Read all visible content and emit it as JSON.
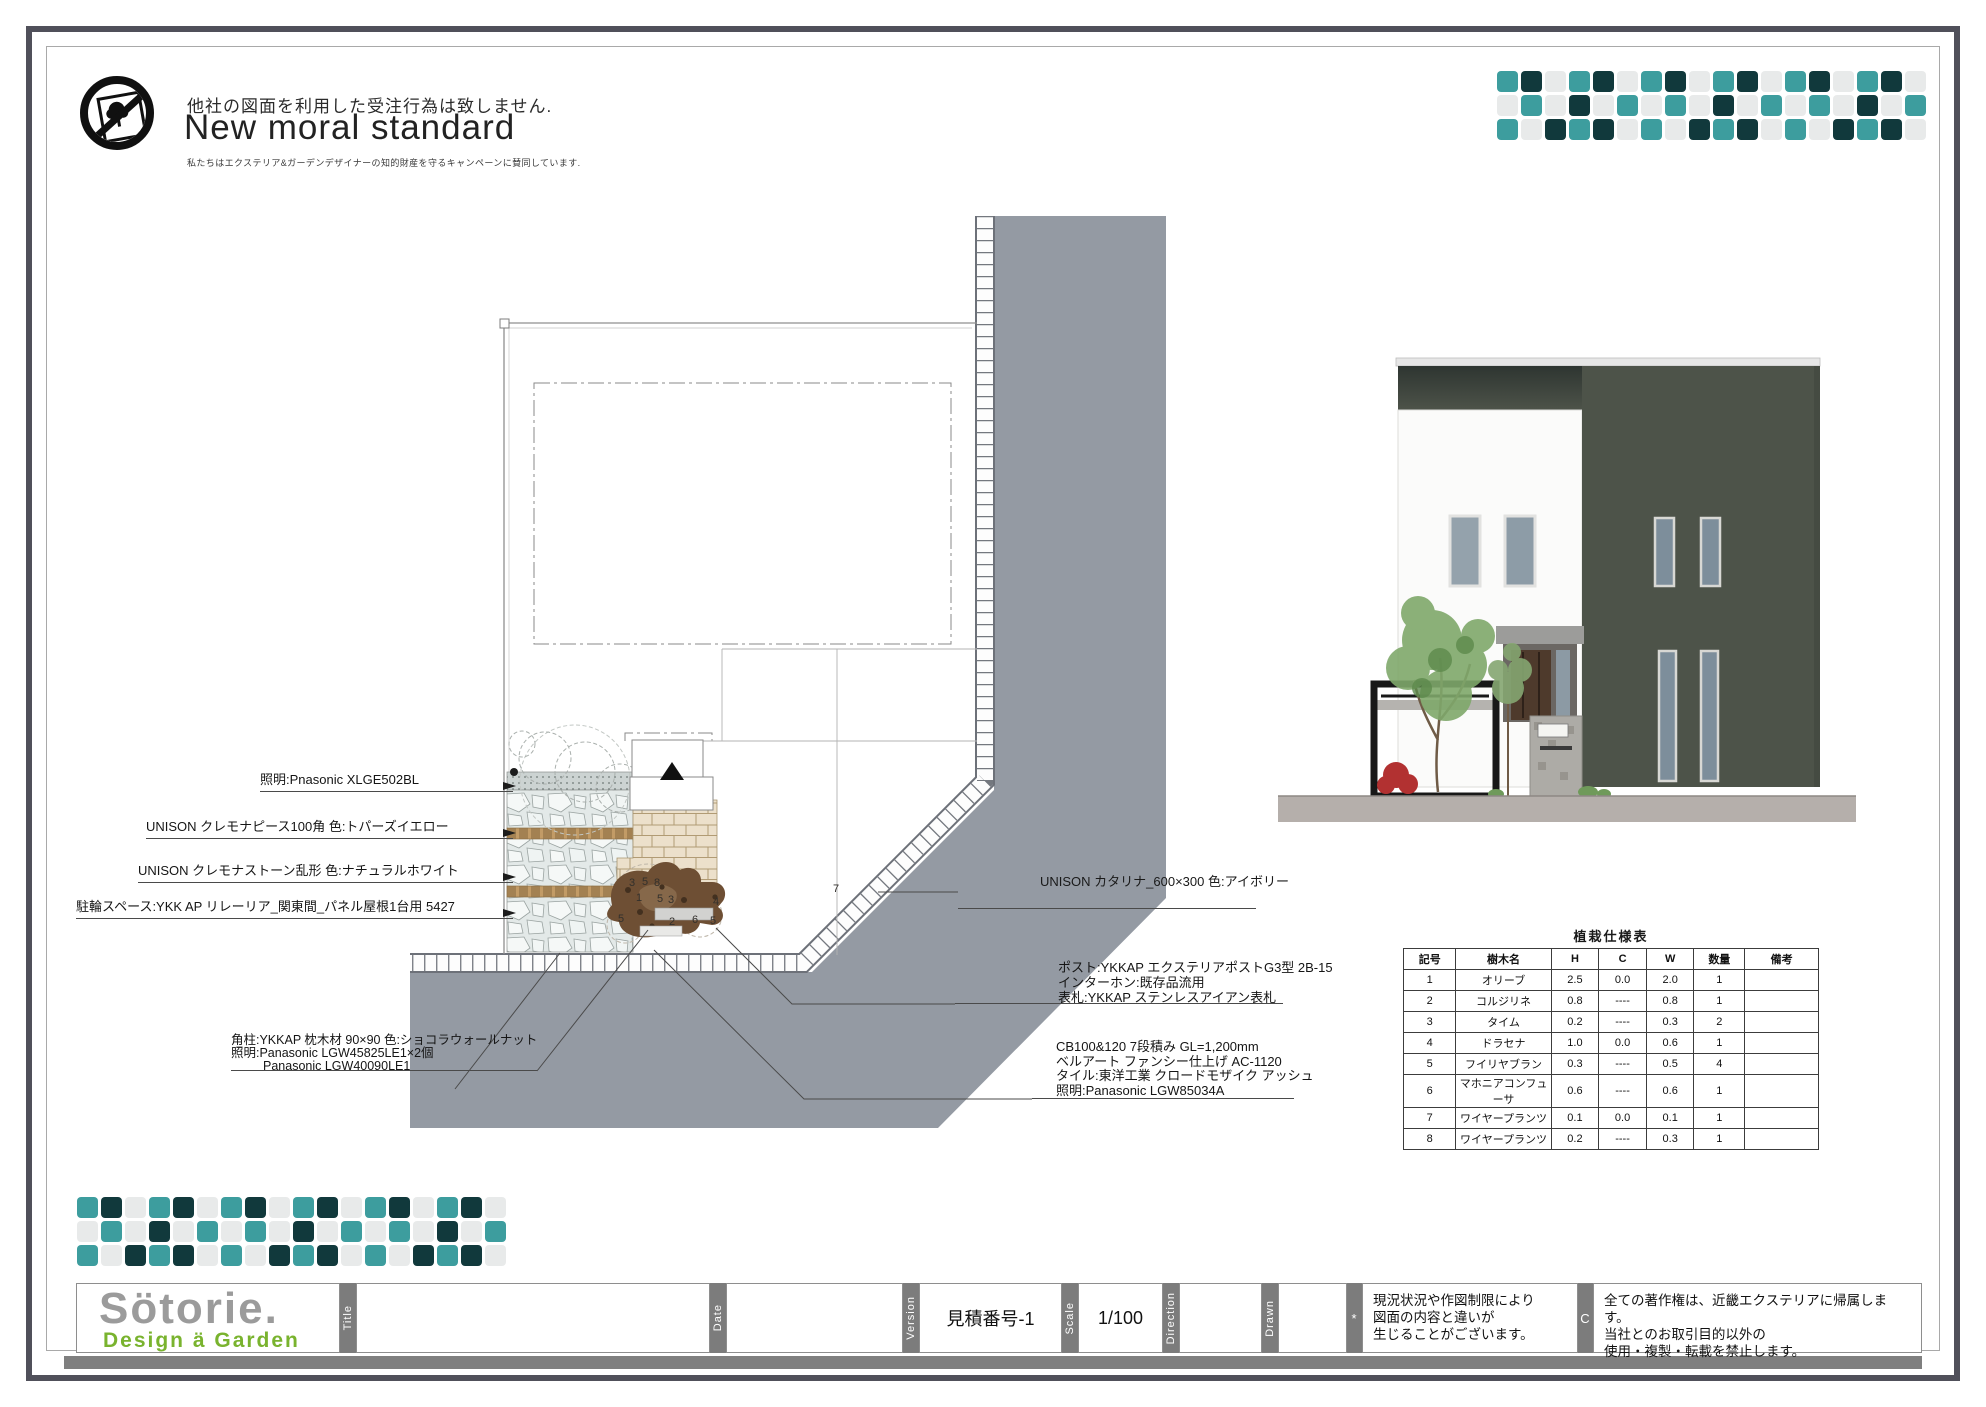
{
  "header": {
    "disclaimer": "他社の図面を利用した受注行為は致しません.",
    "brand_title": "New moral standard",
    "brand_subtitle": "私たちはエクステリア&ガーデンデザイナーの知的財産を守るキャンペーンに賛同しています."
  },
  "mosaic": {
    "colors": {
      "T": "#3d9d9e",
      "D": "#11393c",
      "G": "#e8eaea"
    },
    "rows": [
      "TDGTDGTDGTDGTDGTDG",
      "GTGDGTGTGDGTGTGDGT",
      "TGDTDGTGDTDGTGDTDG"
    ]
  },
  "plan": {
    "annotations_left": [
      "照明:Pnasonic XLGE502BL",
      "UNISON クレモナピース100角  色:トパーズイエロー",
      "UNISON クレモナストーン乱形 色:ナチュラルホワイト",
      "駐輪スペース:YKK AP リレーリア_関東間_パネル屋根1台用 5427"
    ],
    "annotation_katarina": "UNISON カタリナ_600×300 色:アイボリー",
    "pillar_block": [
      "角柱:YKKAP 枕木材 90×90 色:ショコラウォールナット",
      "照明:Panasonic LGW45825LE1×2個",
      "Panasonic LGW40090LE1"
    ],
    "post_block": [
      "ポスト:YKKAP エクステリアポストG3型 2B-15",
      "インターホン:既存品流用",
      "表札:YKKAP ステンレスアイアン表札"
    ],
    "cb_block": [
      "CB100&120  7段積み  GL=1,200mm",
      "ベルアート  ファンシー仕上げ  AC-1120",
      "タイル:東洋工業 クロードモザイク アッシュ",
      "照明:Panasonic LGW85034A"
    ],
    "plant_labels": [
      {
        "label": "3",
        "x": 632,
        "y": 886
      },
      {
        "label": "5",
        "x": 645,
        "y": 885
      },
      {
        "label": "8",
        "x": 657,
        "y": 886
      },
      {
        "label": "1",
        "x": 639,
        "y": 901
      },
      {
        "label": "5",
        "x": 660,
        "y": 902
      },
      {
        "label": "3",
        "x": 671,
        "y": 903
      },
      {
        "label": "4",
        "x": 716,
        "y": 905
      },
      {
        "label": "5",
        "x": 621,
        "y": 922
      },
      {
        "label": "2",
        "x": 672,
        "y": 925
      },
      {
        "label": "6",
        "x": 695,
        "y": 923
      },
      {
        "label": "5",
        "x": 713,
        "y": 924
      },
      {
        "label": "7",
        "x": 836,
        "y": 892
      }
    ]
  },
  "table": {
    "title": "植栽仕様表",
    "headers": [
      "記号",
      "樹木名",
      "H",
      "C",
      "W",
      "数量",
      "備考"
    ],
    "rows": [
      [
        "1",
        "オリーブ",
        "2.5",
        "0.0",
        "2.0",
        "1",
        ""
      ],
      [
        "2",
        "コルジリネ",
        "0.8",
        "----",
        "0.8",
        "1",
        ""
      ],
      [
        "3",
        "タイム",
        "0.2",
        "----",
        "0.3",
        "2",
        ""
      ],
      [
        "4",
        "ドラセナ",
        "1.0",
        "0.0",
        "0.6",
        "1",
        ""
      ],
      [
        "5",
        "フイリヤブラン",
        "0.3",
        "----",
        "0.5",
        "4",
        ""
      ],
      [
        "6",
        "マホニアコンフューサ",
        "0.6",
        "----",
        "0.6",
        "1",
        ""
      ],
      [
        "7",
        "ワイヤープランツ",
        "0.1",
        "0.0",
        "0.1",
        "1",
        ""
      ],
      [
        "8",
        "ワイヤープランツ",
        "0.2",
        "----",
        "0.3",
        "1",
        ""
      ]
    ]
  },
  "titleblock": {
    "logo_main": "Sötorie.",
    "logo_sub": "Design ä Garden",
    "labels": {
      "title": "Title",
      "date": "Date",
      "version": "Version",
      "scale": "Scale",
      "direction": "Direction",
      "drawn": "Drawn",
      "note_mark": "*",
      "copyright_mark": "C"
    },
    "version_value": "見積番号-1",
    "scale_value": "1/100",
    "note_lines": [
      "現況状況や作図制限により",
      "図面の内容と違いが",
      "生じることがございます。"
    ],
    "copyright_lines": [
      "全ての著作権は、近畿エクステリアに帰属します。",
      "当社とのお取引目的以外の",
      "使用・複製・転載を禁止します。"
    ]
  }
}
